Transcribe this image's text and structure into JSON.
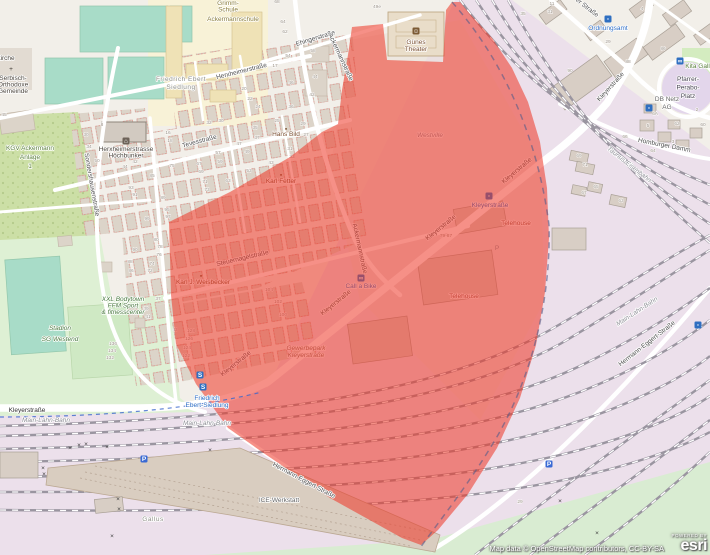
{
  "map": {
    "attribution": "Map data © OpenStreetMap contributors, CC-BY-SA",
    "esri": {
      "powered_by": "POWERED BY",
      "brand": "esri"
    },
    "colors": {
      "overlay_red": "#ee3524",
      "railway_land": "#ece0eb",
      "pitch_teal": "#a8dcc8",
      "stadium_green": "#def0d4",
      "allotment_green": "#ccdfa6",
      "transit_blue": "#2f6fc1",
      "road_white": "#ffffff"
    },
    "labels": [
      {
        "n": "label-grimm-schule",
        "c": "school",
        "x": 228,
        "y": 5,
        "l": [
          "Grimm-",
          "Schule"
        ],
        "f": 5.2,
        "h": 6.5
      },
      {
        "n": "label-ackermannschule",
        "c": "school",
        "x": 233,
        "y": 21,
        "l": [
          "Ackermannschule"
        ],
        "f": 6.5
      },
      {
        "n": "label-kirche-fragment",
        "c": "poi-dark",
        "x": 6,
        "y": 60,
        "l": [
          "kirche"
        ],
        "f": 5
      },
      {
        "n": "label-serbisch-orthodoxe-gemeinde",
        "c": "poi-dark",
        "x": 13,
        "y": 80,
        "l": [
          "Serbisch-",
          "Orthodoxe",
          "Gemeinde"
        ],
        "f": 5,
        "h": 6.5
      },
      {
        "n": "label-friedrich-ebert-siedlung-district",
        "c": "district",
        "x": 181,
        "y": 81,
        "l": [
          "Friedrich Ebert",
          "Siedlung"
        ],
        "f": 6.5,
        "h": 8
      },
      {
        "n": "label-kgv-ackermann-anlage",
        "c": "green",
        "x": 30,
        "y": 150,
        "l": [
          "KGV Ackermann",
          "Anlage",
          "1"
        ],
        "f": 6.5,
        "h": 9
      },
      {
        "n": "label-herxheimerstrasse",
        "c": "street",
        "x": 242,
        "y": 73,
        "r": -14,
        "l": [
          "Herxheimerstraße"
        ],
        "f": 6.5
      },
      {
        "n": "label-ehingerstrasse",
        "c": "street",
        "x": 316,
        "y": 40,
        "r": -17,
        "l": [
          "Ehingerstraße"
        ],
        "f": 6.5
      },
      {
        "n": "label-ackermannstrasse-1",
        "c": "street",
        "x": 339,
        "y": 58,
        "r": 65,
        "l": [
          "Ackermannstraße"
        ],
        "f": 6.5
      },
      {
        "n": "label-ackermannstrasse-2",
        "c": "street",
        "x": 358,
        "y": 249,
        "r": 78,
        "l": [
          "Ackermannstraße"
        ],
        "f": 6.5,
        "u": 1
      },
      {
        "n": "label-tevesstrasse",
        "c": "street",
        "x": 200,
        "y": 143,
        "r": -15,
        "l": [
          "Tevesstraße"
        ],
        "f": 6.5
      },
      {
        "n": "label-sondershausenstrasse",
        "c": "street",
        "x": 90,
        "y": 185,
        "r": 80,
        "l": [
          "Sondershausenstraße"
        ],
        "f": 6.2
      },
      {
        "n": "label-steuernagelstrasse",
        "c": "street",
        "x": 243,
        "y": 260,
        "r": -13,
        "l": [
          "Steuernagelstraße"
        ],
        "f": 6.5,
        "u": 1
      },
      {
        "n": "label-gunes-theater",
        "c": "poi-brown",
        "x": 416,
        "y": 44,
        "l": [
          "Günes",
          "Theater"
        ],
        "f": 6,
        "h": 7
      },
      {
        "n": "label-hans-bild",
        "c": "poi-brown",
        "x": 286,
        "y": 136,
        "l": [
          "Hans Bild"
        ],
        "f": 5
      },
      {
        "n": "label-karl-fetter",
        "c": "poi-brown",
        "x": 281,
        "y": 183,
        "l": [
          "Karl Fetter"
        ],
        "f": 5,
        "u": 1
      },
      {
        "n": "label-karl-weisbecker",
        "c": "poi-brown",
        "x": 203,
        "y": 284,
        "l": [
          "Karl J. Weisbecker"
        ],
        "f": 5,
        "u": 1
      },
      {
        "n": "label-hoechbunker",
        "c": "poi-dark",
        "x": 126,
        "y": 151,
        "l": [
          "Herxheimerstrasse",
          "Höchbunker"
        ],
        "f": 5.2,
        "h": 6.5
      },
      {
        "n": "label-westville",
        "c": "district-it",
        "x": 430,
        "y": 137,
        "l": [
          "Westville"
        ],
        "f": 8,
        "u": 1
      },
      {
        "n": "label-kleyerstrasse-bottom",
        "c": "street-dark",
        "x": 27,
        "y": 412,
        "l": [
          "Kleyerstraße"
        ],
        "f": 6.2
      },
      {
        "n": "label-kleyerstrasse-d1",
        "c": "street",
        "x": 237,
        "y": 365,
        "r": -39,
        "l": [
          "Kleyerstraße"
        ],
        "f": 6.5,
        "u": 1
      },
      {
        "n": "label-kleyerstrasse-d2",
        "c": "street",
        "x": 337,
        "y": 304,
        "r": -39,
        "l": [
          "Kleyerstraße"
        ],
        "f": 6.5,
        "u": 1
      },
      {
        "n": "label-kleyerstrasse-d3",
        "c": "street",
        "x": 442,
        "y": 229,
        "r": -39,
        "l": [
          "Kleyerstraße"
        ],
        "f": 6.5,
        "u": 1
      },
      {
        "n": "label-kleyerstrasse-d4",
        "c": "street",
        "x": 518,
        "y": 172,
        "r": -40,
        "l": [
          "Kleyerstraße"
        ],
        "f": 6.5,
        "u": 1
      },
      {
        "n": "label-kleyerstrasse-ne",
        "c": "street",
        "x": 612,
        "y": 88,
        "r": -48,
        "l": [
          "Kleyerstraße"
        ],
        "f": 6.5
      },
      {
        "n": "label-er-strasse-partial",
        "c": "street",
        "x": 586,
        "y": 9,
        "r": 38,
        "l": [
          "er Straße"
        ],
        "f": 6.5
      },
      {
        "n": "label-ordnungsamt",
        "c": "transit-blue",
        "x": 608,
        "y": 30,
        "l": [
          "Ordnungsamt"
        ],
        "f": 5.5
      },
      {
        "n": "label-pfarrer-perabo-platz",
        "c": "place-dark",
        "x": 688,
        "y": 81,
        "l": [
          "Pfarrer-",
          "Perabo-",
          "Platz"
        ],
        "f": 6.2,
        "h": 8.5
      },
      {
        "n": "label-db-netz-ag",
        "c": "poi-gray",
        "x": 667,
        "y": 101,
        "l": [
          "DB Netz",
          "AG"
        ],
        "f": 6,
        "h": 8
      },
      {
        "n": "label-kita",
        "c": "green",
        "x": 701,
        "y": 68,
        "l": [
          "Kita Gallus"
        ],
        "f": 5
      },
      {
        "n": "label-homburger-damm",
        "c": "street",
        "x": 664,
        "y": 147,
        "r": 11,
        "l": [
          "Homburger Damm"
        ],
        "f": 6.5
      },
      {
        "n": "label-taunus-eisenbahn",
        "c": "rail",
        "x": 628,
        "y": 166,
        "r": 38,
        "l": [
          "Taunus-Eisenbahn"
        ],
        "f": 6
      },
      {
        "n": "label-main-lahn-bahn-1",
        "c": "rail",
        "x": 46,
        "y": 422,
        "l": [
          "Main-Lahn-Bahn"
        ],
        "f": 6
      },
      {
        "n": "label-main-lahn-bahn-2",
        "c": "rail",
        "x": 207,
        "y": 425,
        "l": [
          "Main-Lahn-Bahn"
        ],
        "f": 6
      },
      {
        "n": "label-main-lahn-bahn-3",
        "c": "rail",
        "x": 638,
        "y": 313,
        "r": -33,
        "l": [
          "Main-Lahn-Bahn"
        ],
        "f": 6
      },
      {
        "n": "label-stadion-sg-westend",
        "c": "leisure-it",
        "x": 60,
        "y": 330,
        "l": [
          "Stadion",
          "SG Westend"
        ],
        "f": 8,
        "h": 11
      },
      {
        "n": "label-xxl-bodytown",
        "c": "leisure-it",
        "x": 123,
        "y": 301,
        "l": [
          "XXL Bodytown",
          "FFM Sport",
          "& fitnesscenter"
        ],
        "f": 5.3,
        "h": 6.5
      },
      {
        "n": "label-telehouse-1",
        "c": "poi-red-brown",
        "x": 516,
        "y": 225,
        "l": [
          "Telehouse"
        ],
        "f": 6.5,
        "u": 1
      },
      {
        "n": "label-telehouse-2",
        "c": "poi-red-brown",
        "x": 464,
        "y": 298,
        "l": [
          "Telehouse"
        ],
        "f": 6.5,
        "u": 1
      },
      {
        "n": "label-call-a-bike",
        "c": "transit-blue",
        "x": 361,
        "y": 288,
        "l": [
          "Call a Bike"
        ],
        "f": 5.3,
        "u": 1
      },
      {
        "n": "label-kleyerstrasse-stop",
        "c": "transit-blue",
        "x": 490,
        "y": 207,
        "l": [
          "Kleyerstraße"
        ],
        "f": 5.5,
        "u": 1
      },
      {
        "n": "label-gewerbepark-kleyerstrasse",
        "c": "it-brown",
        "x": 306,
        "y": 350,
        "l": [
          "Gewerbepark",
          "Kleyerstraße"
        ],
        "f": 5.3,
        "h": 7,
        "u": 1
      },
      {
        "n": "label-ice-werkstatt",
        "c": "poi-gray",
        "x": 279,
        "y": 502,
        "l": [
          "ICE-Werkstatt"
        ],
        "f": 6.5
      },
      {
        "n": "label-gallus",
        "c": "district",
        "x": 153,
        "y": 521,
        "l": [
          "Gallus"
        ],
        "f": 7,
        "s": 1.5
      },
      {
        "n": "label-friedrich-ebert-siedlung-sbahn",
        "c": "transit-blue",
        "x": 207,
        "y": 400,
        "l": [
          "Friedrich",
          "Ebert-Siedlung"
        ],
        "f": 5.5,
        "h": 7
      },
      {
        "n": "label-hermann-eggert-strasse-1",
        "c": "street",
        "x": 303,
        "y": 482,
        "r": 28,
        "l": [
          "Hermann-Eggert-Straße"
        ],
        "f": 6.2
      },
      {
        "n": "label-hermann-eggert-strasse-2",
        "c": "street",
        "x": 648,
        "y": 345,
        "r": -38,
        "l": [
          "Hermann-Eggert-Straße"
        ],
        "f": 6.2
      }
    ],
    "house_numbers": [
      [
        "68",
        277,
        3
      ],
      [
        "64",
        283,
        23
      ],
      [
        "62",
        285,
        33
      ],
      [
        "54",
        288,
        57
      ],
      [
        "46",
        291,
        84
      ],
      [
        "36",
        291,
        108
      ],
      [
        "24",
        258,
        108
      ],
      [
        "22",
        250,
        100
      ],
      [
        "20",
        244,
        90
      ],
      [
        "17",
        275,
        67
      ],
      [
        "49e",
        377,
        8
      ],
      [
        "58",
        313,
        52
      ],
      [
        "44",
        315,
        78
      ],
      [
        "42",
        312,
        96
      ],
      [
        "32",
        209,
        124
      ],
      [
        "30",
        221,
        122
      ],
      [
        "25",
        277,
        122
      ],
      [
        "29",
        303,
        125
      ],
      [
        "27",
        306,
        136
      ],
      [
        "35",
        255,
        129
      ],
      [
        "37",
        257,
        139
      ],
      [
        "47",
        239,
        145
      ],
      [
        "49",
        247,
        153
      ],
      [
        "57",
        218,
        154
      ],
      [
        "59",
        220,
        163
      ],
      [
        "67",
        199,
        165
      ],
      [
        "69",
        201,
        173
      ],
      [
        "31",
        290,
        150
      ],
      [
        "33",
        292,
        158
      ],
      [
        "43",
        271,
        164
      ],
      [
        "53",
        249,
        172
      ],
      [
        "63",
        228,
        182
      ],
      [
        "71",
        205,
        183
      ],
      [
        "73",
        207,
        191
      ],
      [
        "75",
        172,
        167
      ],
      [
        "85",
        152,
        177
      ],
      [
        "95",
        167,
        211
      ],
      [
        "97",
        168,
        218
      ],
      [
        "99",
        147,
        220
      ],
      [
        "16",
        168,
        134
      ],
      [
        "18",
        170,
        142
      ],
      [
        "93",
        131,
        189
      ],
      [
        "91",
        135,
        196
      ],
      [
        "89",
        163,
        199
      ],
      [
        "8",
        102,
        126
      ],
      [
        "30",
        86,
        136
      ],
      [
        "34",
        89,
        148
      ],
      [
        "50",
        97,
        162
      ],
      [
        "44",
        125,
        168
      ],
      [
        "42",
        135,
        163
      ],
      [
        "45",
        4,
        116
      ],
      [
        "90",
        135,
        251
      ],
      [
        "88",
        130,
        263
      ],
      [
        "86",
        131,
        272
      ],
      [
        "80",
        156,
        241
      ],
      [
        "78",
        160,
        248
      ],
      [
        "76",
        159,
        256
      ],
      [
        "74",
        152,
        265
      ],
      [
        "72",
        150,
        272
      ],
      [
        "37",
        158,
        300
      ],
      [
        "39",
        146,
        310
      ],
      [
        "41",
        148,
        318
      ],
      [
        "43",
        175,
        331
      ],
      [
        "136",
        113,
        345
      ],
      [
        "134",
        112,
        352
      ],
      [
        "132",
        110,
        359
      ],
      [
        "104",
        269,
        291
      ],
      [
        "102",
        278,
        303
      ],
      [
        "100",
        283,
        316
      ],
      [
        "128",
        191,
        332
      ],
      [
        "126",
        189,
        340
      ],
      [
        "124",
        187,
        349
      ],
      [
        "122",
        186,
        357
      ],
      [
        "79-87",
        446,
        237
      ],
      [
        "31",
        550,
        13
      ],
      [
        "29",
        608,
        43
      ],
      [
        "90",
        570,
        72
      ],
      [
        "88",
        628,
        63
      ],
      [
        "86",
        663,
        50
      ],
      [
        "4",
        642,
        10
      ],
      [
        "5",
        648,
        127
      ],
      [
        "66",
        625,
        138
      ],
      [
        "64",
        653,
        152
      ],
      [
        "3",
        673,
        143
      ],
      [
        "2",
        697,
        111
      ],
      [
        "6A",
        655,
        115
      ],
      [
        "62",
        677,
        125
      ],
      [
        "60",
        703,
        126
      ],
      [
        "69",
        579,
        157
      ],
      [
        "71",
        585,
        166
      ],
      [
        "67",
        584,
        194
      ],
      [
        "65",
        596,
        188
      ],
      [
        "63",
        621,
        202
      ],
      [
        "35",
        523,
        15
      ],
      [
        "11",
        552,
        5
      ],
      [
        "29",
        520,
        503
      ]
    ],
    "icons": [
      {
        "n": "theater-masks-icon",
        "x": 416,
        "y": 31,
        "b": "#7c5a34",
        "g": "☺"
      },
      {
        "n": "church-cross-icon",
        "x": 11,
        "y": 69,
        "f": "#3f3a34",
        "g": "+",
        "fs": 8
      },
      {
        "n": "memorial-hans-bild-icon",
        "x": 286,
        "y": 129,
        "f": "#7a5230",
        "g": "▪",
        "fs": 5
      },
      {
        "n": "memorial-karl-fetter-icon",
        "x": 281,
        "y": 175,
        "f": "#7a5230",
        "g": "▪",
        "fs": 5,
        "u": 1
      },
      {
        "n": "memorial-weisbecker-icon",
        "x": 201,
        "y": 276,
        "f": "#7a5230",
        "g": "▪",
        "fs": 5,
        "u": 1
      },
      {
        "n": "bunker-icon",
        "x": 126,
        "y": 141,
        "b": "#6d6258",
        "g": "⌂"
      },
      {
        "n": "sbahn-icon-1",
        "x": 200,
        "y": 375,
        "b": "#2f6fc1",
        "g": "S"
      },
      {
        "n": "sbahn-icon-2",
        "x": 203,
        "y": 387,
        "b": "#2f6fc1",
        "g": "S"
      },
      {
        "n": "tram-stop-kleyerstrasse-icon",
        "x": 489,
        "y": 196,
        "b": "#2f6fc1",
        "g": "▫",
        "u": 1
      },
      {
        "n": "tram-stop-ordnungsamt-icon",
        "x": 608,
        "y": 19,
        "b": "#2f6fc1",
        "g": "▫"
      },
      {
        "n": "tram-stop-perabo-icon",
        "x": 649,
        "y": 108,
        "b": "#2f6fc1",
        "g": "▫"
      },
      {
        "n": "transit-stop-icon-right",
        "x": 698,
        "y": 325,
        "b": "#2f6fc1",
        "g": "▫"
      },
      {
        "n": "call-a-bike-icon",
        "x": 361,
        "y": 278,
        "b": "#2f6fc1",
        "g": "∞",
        "u": 1
      },
      {
        "n": "bike-rental-icon-kita",
        "x": 680,
        "y": 61,
        "b": "#2f6fc1",
        "g": "∞"
      },
      {
        "n": "parking-icon-yard",
        "x": 144,
        "y": 459,
        "b": "#3a6ad4",
        "g": "P"
      },
      {
        "n": "parking-icon-right",
        "x": 549,
        "y": 464,
        "b": "#3a6ad4",
        "g": "P"
      },
      {
        "n": "parking-icon-telehouse",
        "x": 497,
        "y": 248,
        "f": "#8d94a0",
        "g": "P",
        "fs": 6,
        "u": 1
      },
      {
        "n": "rail-crossing-icon",
        "x": 70,
        "y": 448,
        "f": "#3c3c3c",
        "g": "×",
        "fs": 6
      },
      {
        "n": "rail-crossing-icon",
        "x": 79,
        "y": 445,
        "f": "#3c3c3c",
        "g": "×",
        "fs": 6
      },
      {
        "n": "rail-crossing-icon",
        "x": 86,
        "y": 444,
        "f": "#3c3c3c",
        "g": "×",
        "fs": 6
      },
      {
        "n": "rail-crossing-icon",
        "x": 107,
        "y": 447,
        "f": "#3c3c3c",
        "g": "×",
        "fs": 6
      },
      {
        "n": "rail-crossing-icon",
        "x": 43,
        "y": 468,
        "f": "#3c3c3c",
        "g": "×",
        "fs": 6
      },
      {
        "n": "rail-crossing-icon",
        "x": 44,
        "y": 474,
        "f": "#3c3c3c",
        "g": "×",
        "fs": 6
      },
      {
        "n": "rail-crossing-icon",
        "x": 118,
        "y": 499,
        "f": "#3c3c3c",
        "g": "×",
        "fs": 6
      },
      {
        "n": "rail-crossing-icon",
        "x": 119,
        "y": 509,
        "f": "#3c3c3c",
        "g": "×",
        "fs": 6
      },
      {
        "n": "rail-crossing-icon",
        "x": 112,
        "y": 536,
        "f": "#3c3c3c",
        "g": "×",
        "fs": 6
      },
      {
        "n": "rail-crossing-icon",
        "x": 210,
        "y": 450,
        "f": "#3c3c3c",
        "g": "×",
        "fs": 6
      },
      {
        "n": "rail-crossing-icon",
        "x": 560,
        "y": 501,
        "f": "#3c3c3c",
        "g": "×",
        "fs": 6
      },
      {
        "n": "rail-crossing-icon",
        "x": 597,
        "y": 533,
        "f": "#3c3c3c",
        "g": "×",
        "fs": 6
      }
    ]
  }
}
